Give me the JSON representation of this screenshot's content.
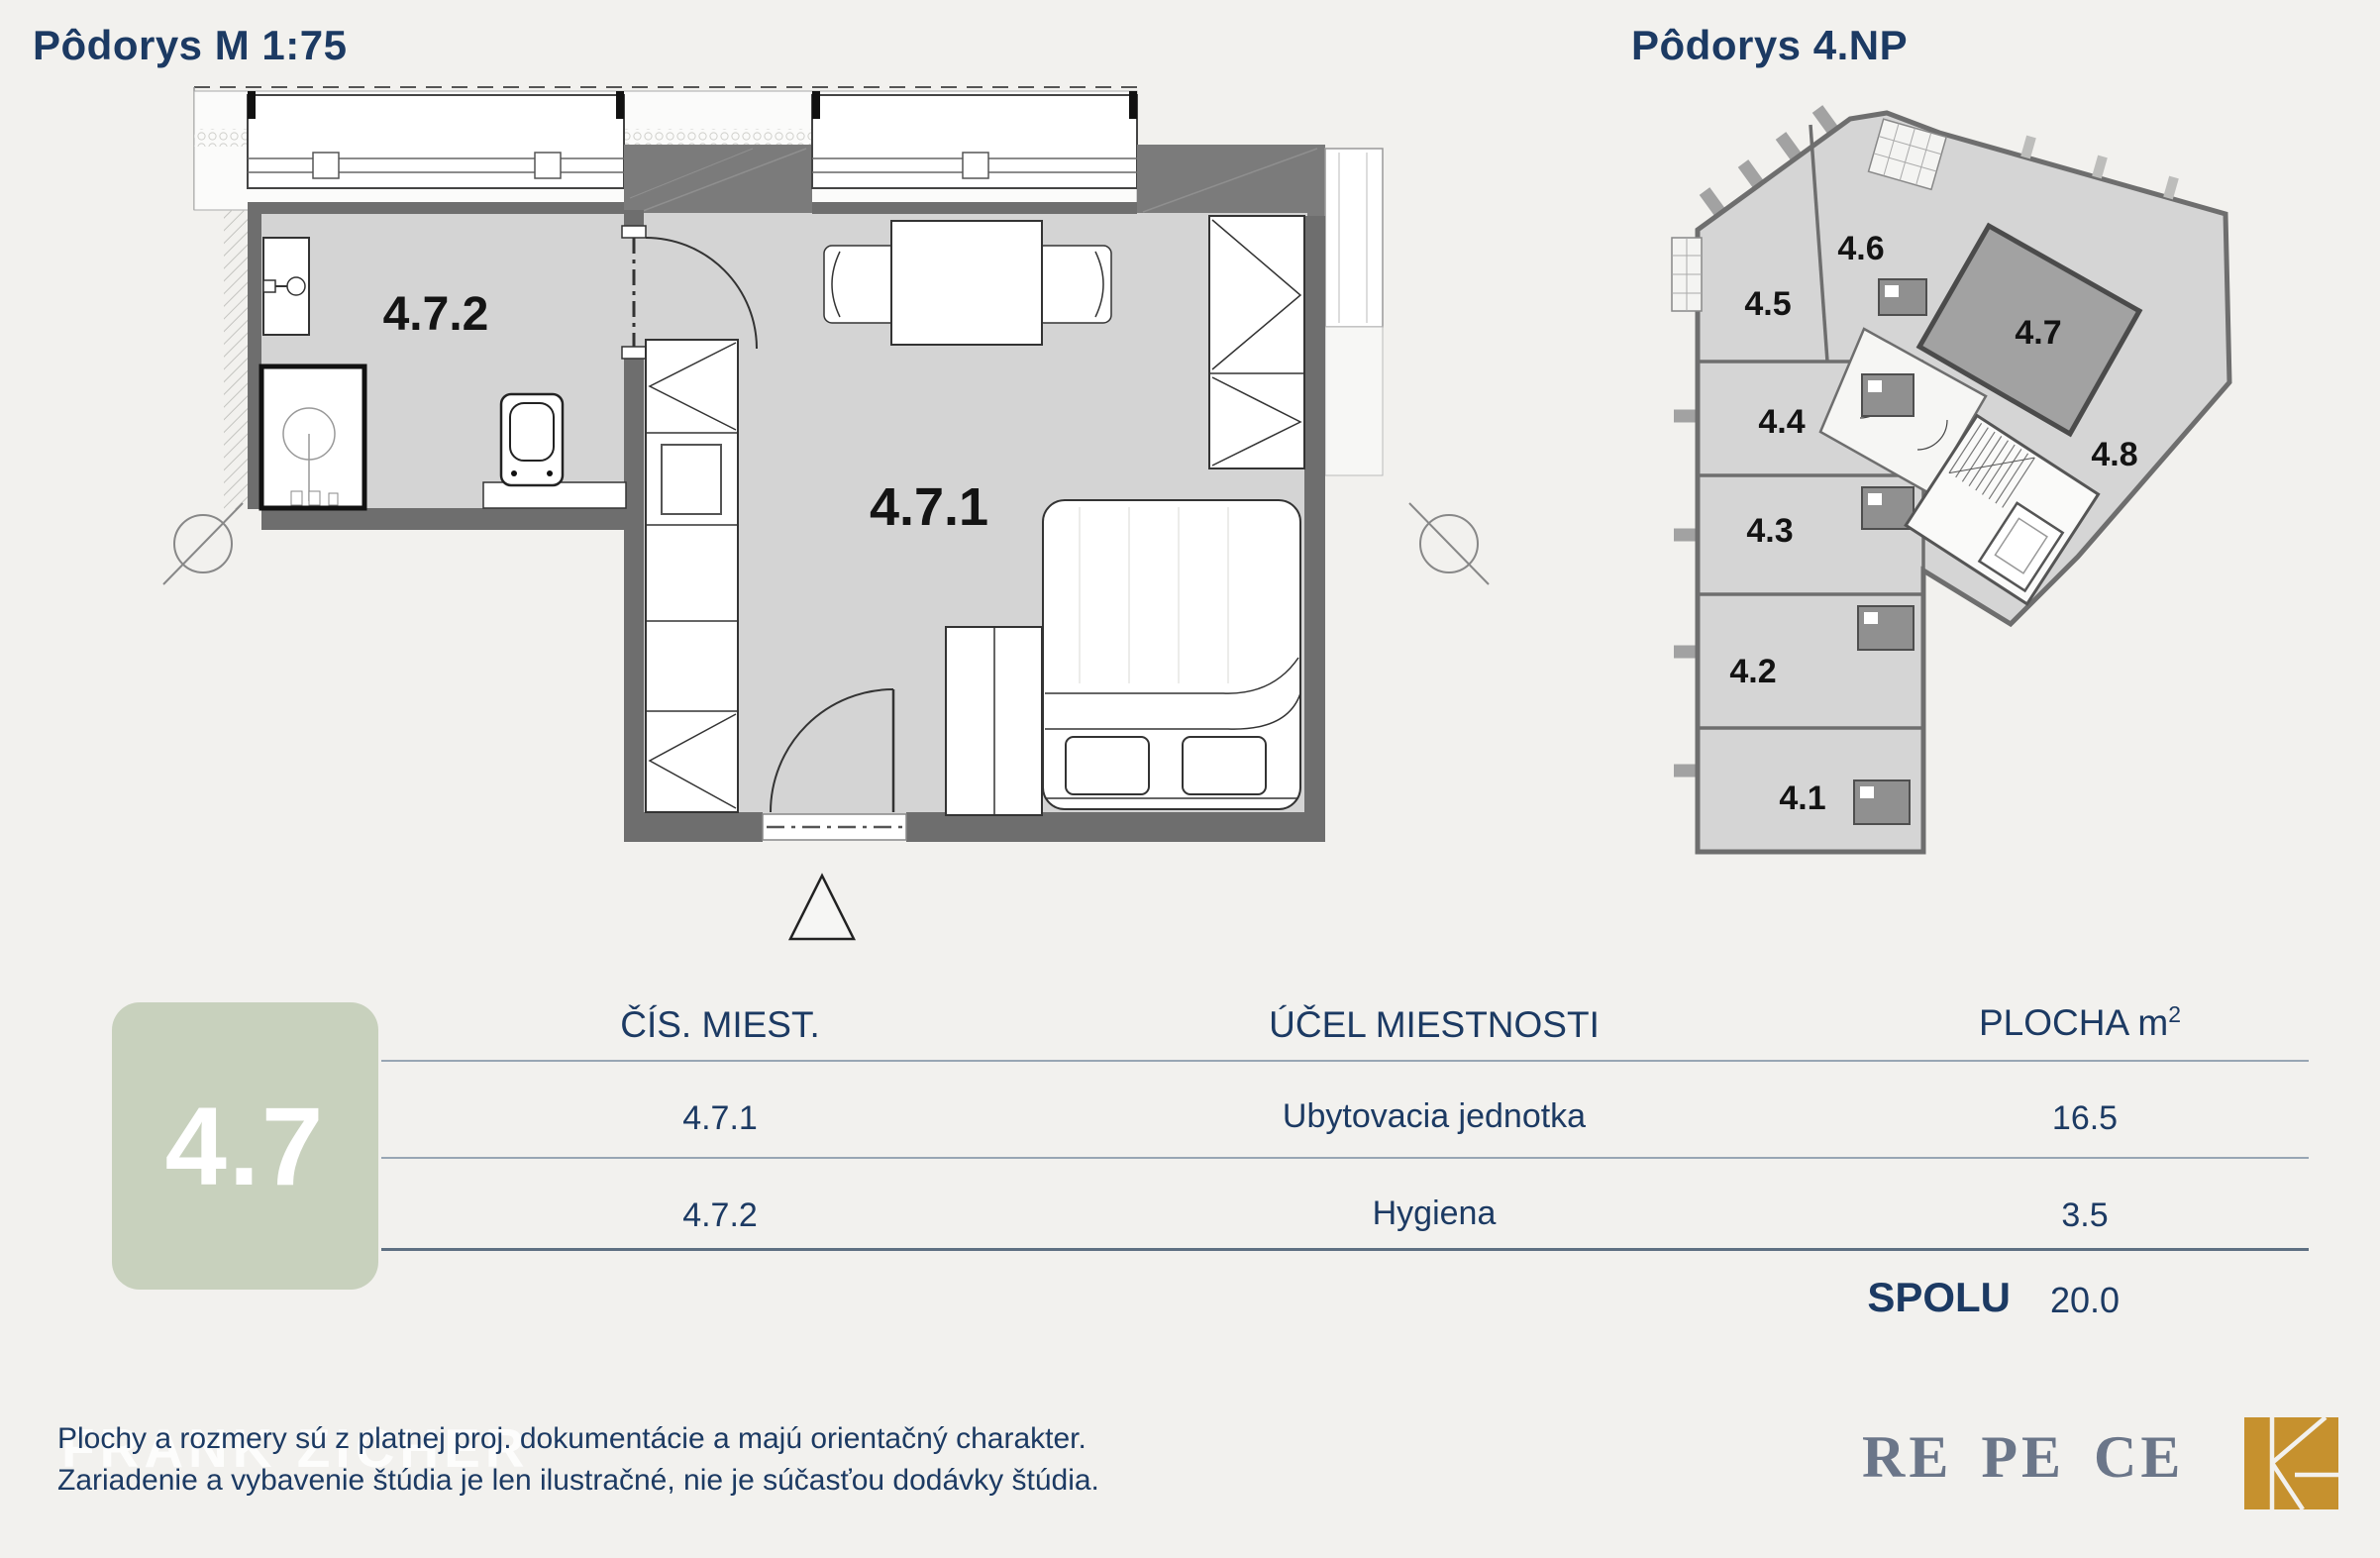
{
  "titles": {
    "left": "Pôdorys M 1:75",
    "right": "Pôdorys 4.NP"
  },
  "detail_plan": {
    "room_labels": {
      "main": "4.7.1",
      "bath": "4.7.2"
    }
  },
  "overview_plan": {
    "highlighted_unit": "4.7",
    "units": [
      {
        "label": "4.1"
      },
      {
        "label": "4.2"
      },
      {
        "label": "4.3"
      },
      {
        "label": "4.4"
      },
      {
        "label": "4.5"
      },
      {
        "label": "4.6"
      },
      {
        "label": "4.7"
      },
      {
        "label": "4.8"
      }
    ]
  },
  "unit_badge": {
    "label": "4.7"
  },
  "table": {
    "col_num": "ČÍS. MIEST.",
    "col_purpose": "ÚČEL MIESTNOSTI",
    "col_area": "PLOCHA m",
    "col_area_sup": "2",
    "rows": [
      {
        "num": "4.7.1",
        "purpose": "Ubytovacia jednotka",
        "area": "16.5"
      },
      {
        "num": "4.7.2",
        "purpose": "Hygiena",
        "area": "3.5"
      }
    ],
    "total_label": "SPOLU",
    "total_value": "20.0"
  },
  "footer": {
    "line1": "Plochy a rozmery sú z platnej proj. dokumentácie a majú orientačný charakter.",
    "line2": "Zariadenie a vybavenie štúdia je len ilustračné, nie je súčasťou dodávky štúdia.",
    "watermark": "FRANK ZICHER",
    "brand": "RE PE CE"
  },
  "colors": {
    "navy": "#1c3a63",
    "badge_green": "#c8d1bd",
    "brand_gray": "#6b7689",
    "logo_gold": "#c6912e",
    "plan_floor": "#d4d4d4",
    "plan_wall": "#6e6e6e",
    "highlight_room": "#a2a2a2",
    "background": "#f2f1ee"
  }
}
